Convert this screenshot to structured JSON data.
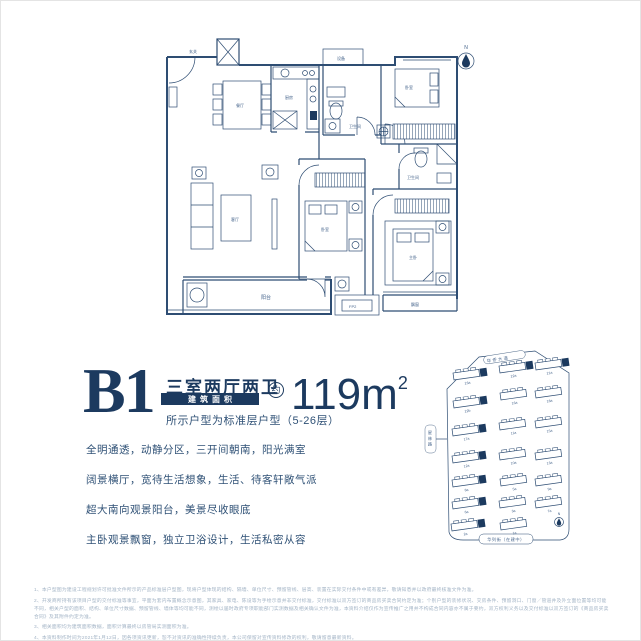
{
  "accent_color": "#1c3a5f",
  "line_color": "#2e4d73",
  "floor_plan": {
    "north_label": "N",
    "rooms": {
      "entry": "玄关",
      "dining": "餐厅",
      "kitchen": "厨房",
      "bath1": "卫生间",
      "bedroom1": "卧室",
      "living": "客厅",
      "bedroom2": "卧室",
      "bath2": "卫生间",
      "master": "主卧",
      "balcony": "阳台",
      "bay_window": "飘窗",
      "equipment": "设备",
      "ac_unit": "FP2"
    }
  },
  "info": {
    "plan_code": "B1",
    "layout": "三室两厅两卫",
    "area_label": "建筑面积",
    "approx": "约",
    "area_value": "119m",
    "area_sup": "2",
    "floor_note": "所示户型为标准层户型（5-26层）"
  },
  "features": [
    "全明通透，动静分区，三开间朝南，阳光满室",
    "阔景横厅，宽待生活想象，生活、待客轩敞气派",
    "超大南向观景阳台，美景尽收眼底",
    "主卧观景飘窗，独立卫浴设计，生活私密从容"
  ],
  "site_map": {
    "road_top": "华侨大道",
    "road_left": "星林路",
    "road_bottom": "华列街（在建中）",
    "north_label": "N",
    "buildings": [
      {
        "label": "23a",
        "hl": true
      },
      {
        "label": "22b",
        "hl": true
      },
      {
        "label": "17a",
        "hl": true
      },
      {
        "label": "12a",
        "hl": true
      },
      {
        "label": "8a",
        "hl": true
      },
      {
        "label": "6a",
        "hl": true
      },
      {
        "label": "2a",
        "hl": true
      },
      {
        "label": "22a",
        "hl": true
      },
      {
        "label": "16a",
        "hl": false
      },
      {
        "label": "11a",
        "hl": false
      },
      {
        "label": "10a",
        "hl": false
      },
      {
        "label": "5a",
        "hl": false
      },
      {
        "label": "3a",
        "hl": false
      },
      {
        "label": "1a",
        "hl": false
      },
      {
        "label": "21a",
        "hl": true
      },
      {
        "label": "18a",
        "hl": false
      },
      {
        "label": "15a",
        "hl": false
      },
      {
        "label": "13a",
        "hl": false
      },
      {
        "label": "9a",
        "hl": false
      },
      {
        "label": "7a",
        "hl": false
      }
    ]
  },
  "footnotes": [
    "1、本户型图为建设工程规划许可批准文件所示的产品标准层户型图，现将户型体现的结构、隔墙、单位尺寸、预留管线、层高、装置在实际交付条件中或有差异，敬请知悉并以政府最终核准文件为准。",
    "2、开发商所持有该项目户型的交付标准等事宜，平面为套内布置概念示意图，其家具、家电、陈设等为手绘示意并非交付标准，交付标准以双方签订的商品房买卖合同约定为准；个别户型的装修状况、交房条件、预留洞口、门窗／管道井及外立面位置等均可能不同，相关户型的面积、结构、单位尺寸数据、预留管线、墙体等均可能不同，测绘以届时政府专项职能部门实测数据及相关确认文件为准，本资料介绍仅作为宣传推广之用并不构成合同内容亦不属于要约，双方权利义务以及交付标准以双方签订的《商品房买卖合同》及其附件约定为准。",
    "3、相关面积均为建筑面积数据，面积计算最终以房管局实测面积为准。",
    "4、本资料制作时间为2021年1月12日，因各项资讯更新，恕不对资讯的准确性持续负责，本公司保留对宣传资料修改的权利，敬请留意最新资料。"
  ]
}
